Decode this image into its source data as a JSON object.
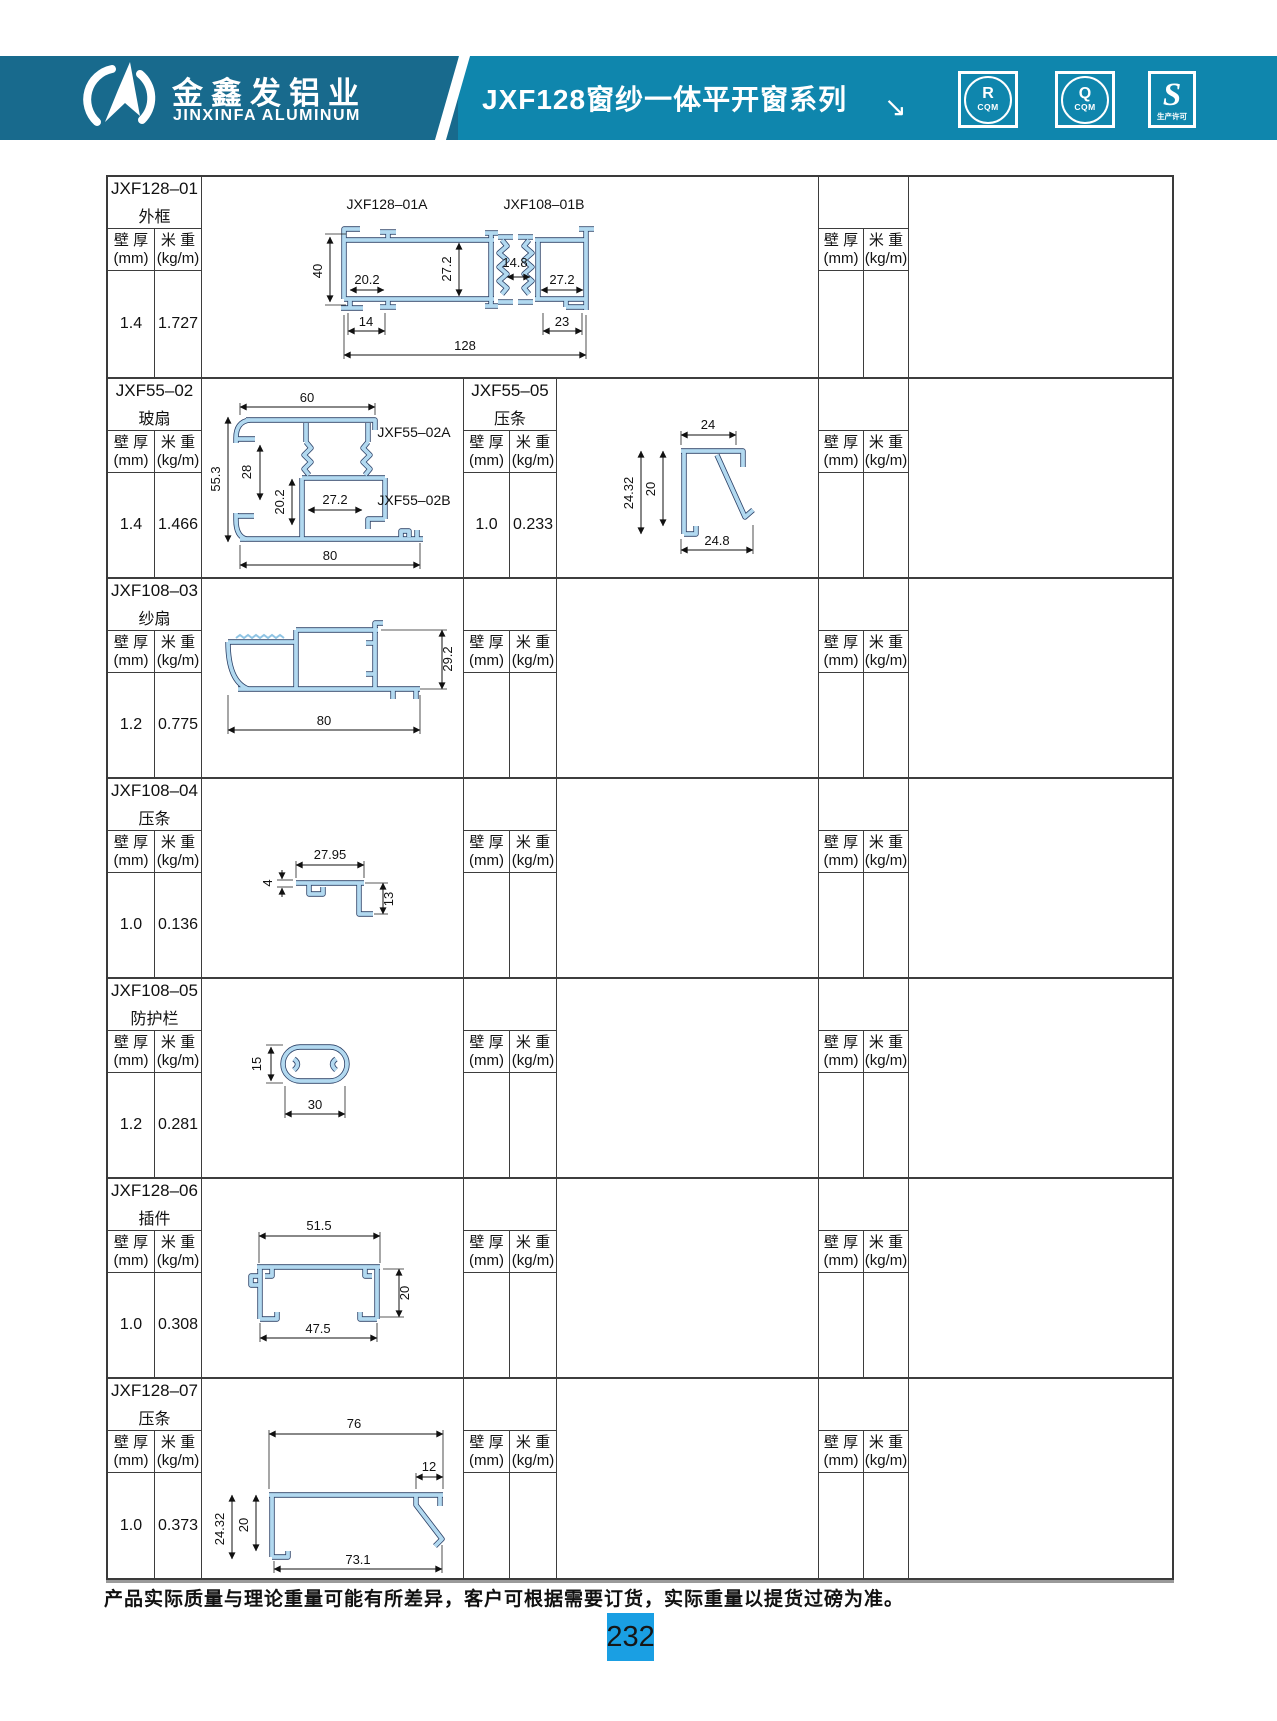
{
  "header": {
    "company_cn": "金鑫发铝业",
    "company_en": "JINXINFA ALUMINUM",
    "series_title": "JXF128窗纱一体平开窗系列",
    "arrow": "↘",
    "badges": [
      {
        "letter": "R",
        "sub": "CQM"
      },
      {
        "letter": "Q",
        "sub": "CQM"
      },
      {
        "letter": "S",
        "sub": "生产许可"
      }
    ]
  },
  "labels": {
    "wt_cn": "壁 厚",
    "wt_unit": "(mm)",
    "mw_cn": "米 重",
    "mw_unit": "(kg/m)"
  },
  "rows": [
    {
      "code": "JXF128–01",
      "name": "外框",
      "wt": "1.4",
      "mw": "1.727"
    },
    {
      "code": "JXF55–02",
      "name": "玻扇",
      "wt": "1.4",
      "mw": "1.466",
      "code2": "JXF55–05",
      "name2": "压条",
      "wt2": "1.0",
      "mw2": "0.233"
    },
    {
      "code": "JXF108–03",
      "name": "纱扇",
      "wt": "1.2",
      "mw": "0.775"
    },
    {
      "code": "JXF108–04",
      "name": "压条",
      "wt": "1.0",
      "mw": "0.136"
    },
    {
      "code": "JXF108–05",
      "name": "防护栏",
      "wt": "1.2",
      "mw": "0.281"
    },
    {
      "code": "JXF128–06",
      "name": "插件",
      "wt": "1.0",
      "mw": "0.308"
    },
    {
      "code": "JXF128–07",
      "name": "压条",
      "wt": "1.0",
      "mw": "0.373"
    }
  ],
  "drawings": {
    "d1": {
      "label_a": "JXF128–01A",
      "label_b": "JXF108–01B",
      "dim_h": "40",
      "dim_w1": "20.2",
      "dim_h1": "27.2",
      "dim_mid": "14.8",
      "dim_w2": "27.2",
      "dim_f1": "14",
      "dim_f2": "23",
      "dim_total": "128"
    },
    "d2": {
      "dim_top": "60",
      "dim_h": "55.3",
      "dim_h1": "28",
      "dim_h2": "20.2",
      "dim_w1": "27.2",
      "label_a": "JXF55–02A",
      "label_b": "JXF55–02B",
      "dim_bottom": "80"
    },
    "d2b": {
      "dim_top": "24",
      "dim_h": "24.32",
      "dim_h1": "20",
      "dim_bottom": "24.8"
    },
    "d3": {
      "dim_h": "29.2",
      "dim_bottom": "80"
    },
    "d4": {
      "dim_top": "27.95",
      "dim_l": "4",
      "dim_r": "13"
    },
    "d5": {
      "dim_h": "15",
      "dim_w": "30"
    },
    "d6": {
      "dim_top": "51.5",
      "dim_r": "20",
      "dim_bottom": "47.5"
    },
    "d7": {
      "dim_top": "76",
      "dim_n": "12",
      "dim_h": "24.32",
      "dim_h1": "20",
      "dim_bottom": "73.1"
    }
  },
  "footer": {
    "note": "产品实际质量与理论重量可能有所差异，客户可根据需要订货，实际重量以提货过磅为准。",
    "page": "232"
  }
}
